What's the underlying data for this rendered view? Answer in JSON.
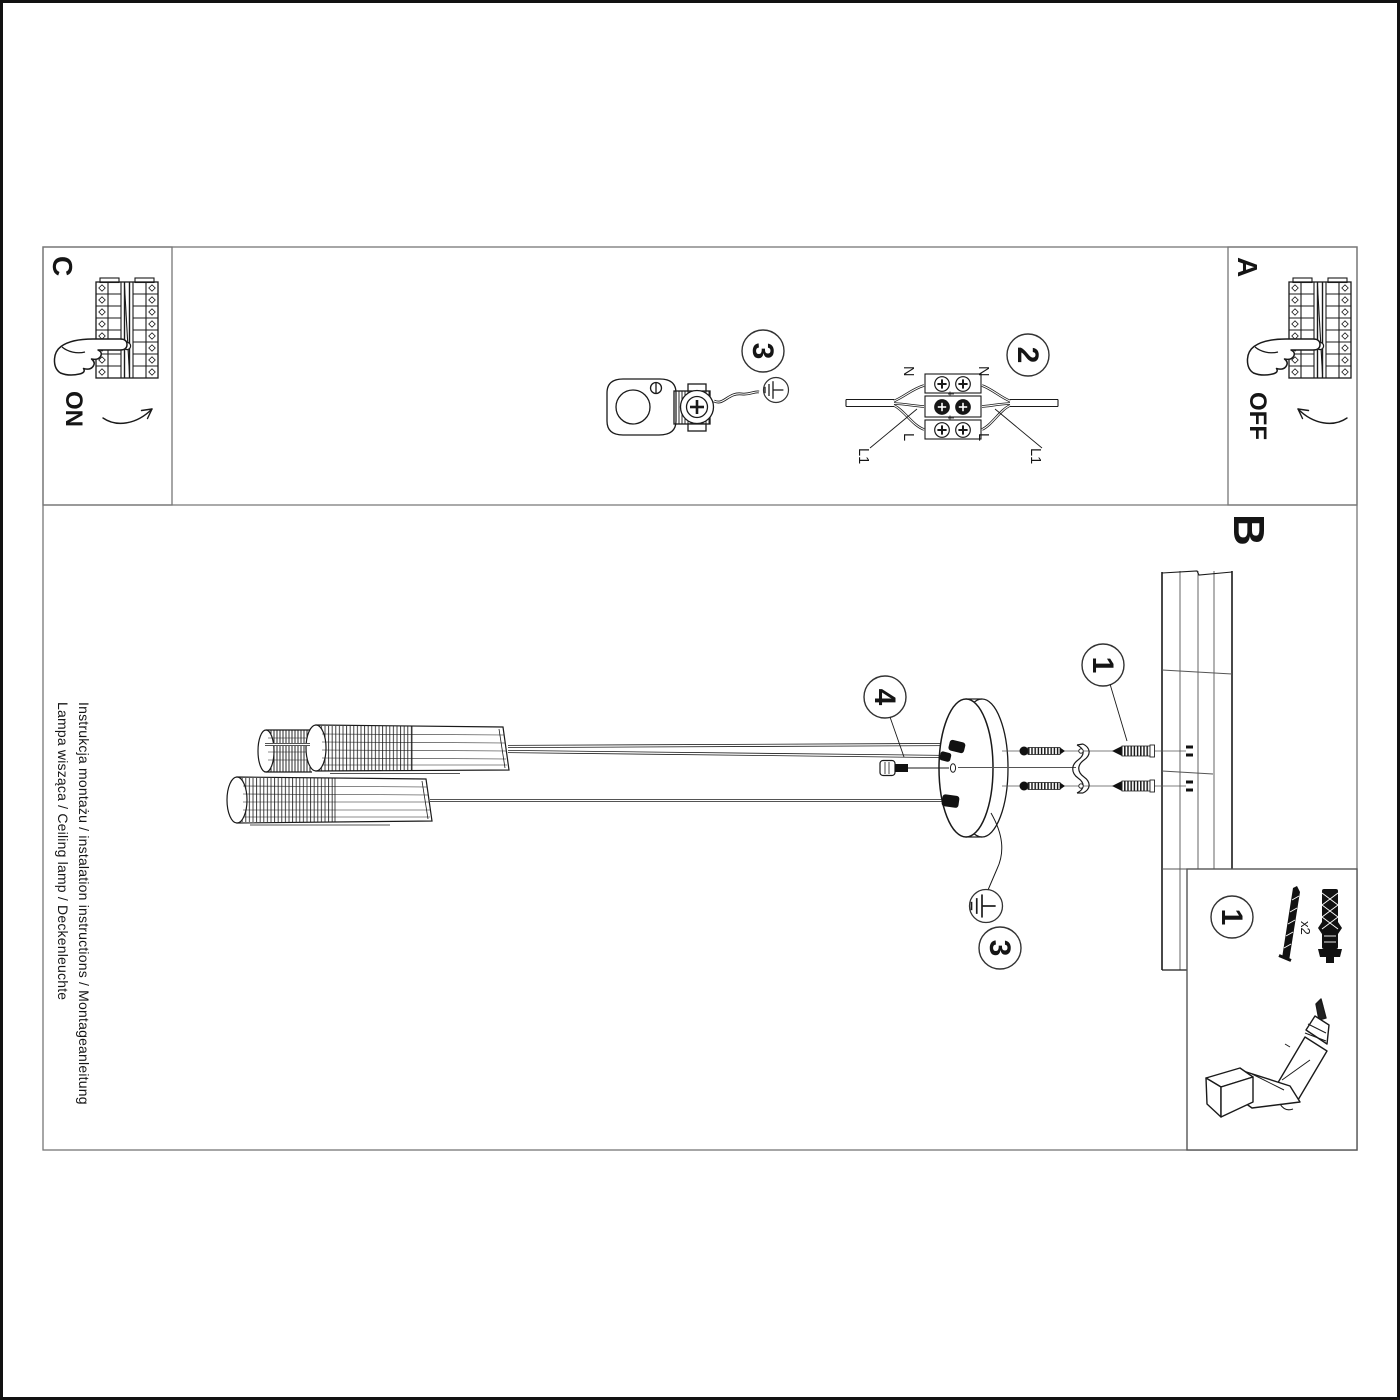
{
  "sheet": {
    "side_text_line1": "Instrukcja montażu / instalation instructions / Montageanleitung",
    "side_text_line2": "Lampa wisząca / Ceiling lamp / Deckenleuchte"
  },
  "sections": {
    "c": {
      "label": "C",
      "state": "ON"
    },
    "a": {
      "label": "A",
      "state": "OFF"
    },
    "b": {
      "label": "B"
    }
  },
  "steps": {
    "s1": "1",
    "s2": "2",
    "s3": "3",
    "s4": "4"
  },
  "wiring": {
    "neutral": "N",
    "live": "L",
    "switched": "L1"
  },
  "accessory": {
    "quantity": "x2"
  },
  "colors": {
    "ink": "#1a1a1a",
    "frame": "#777777",
    "paper": "#ffffff"
  }
}
